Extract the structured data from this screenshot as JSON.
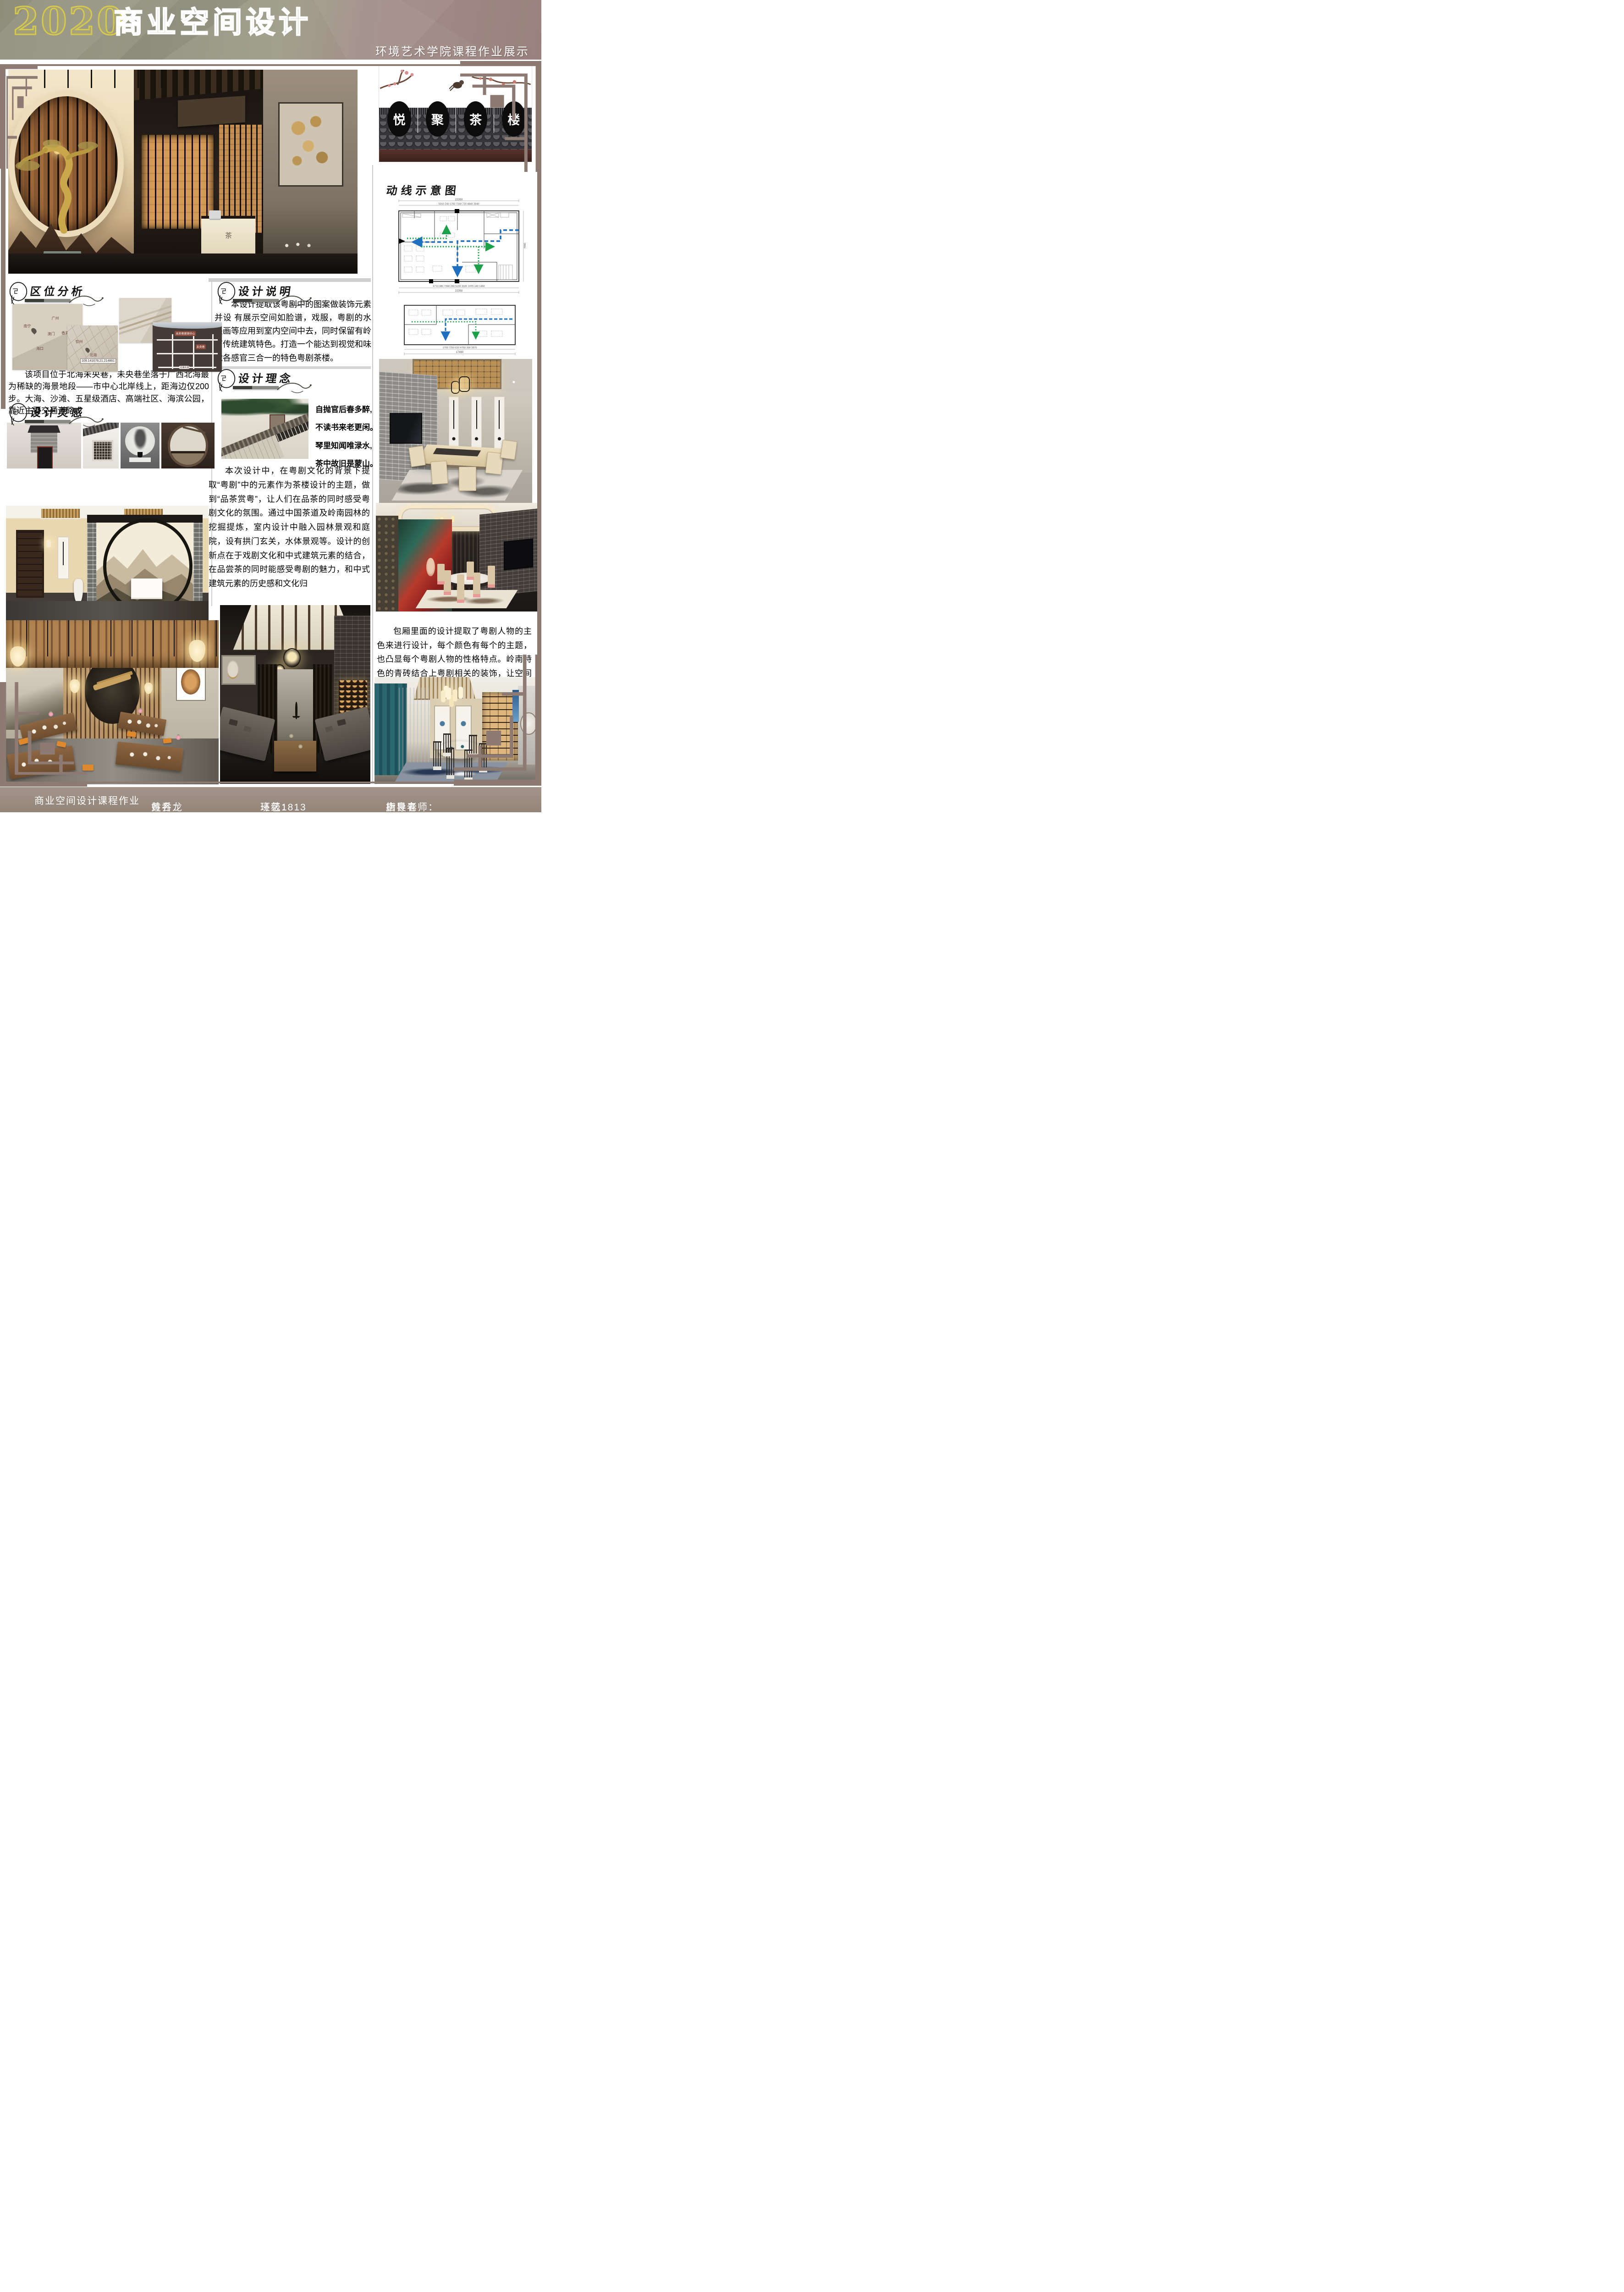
{
  "header": {
    "year": "2020",
    "title": "商业空间设计",
    "subtitle": "环境艺术学院课程作业展示"
  },
  "logo": {
    "chars": [
      "悦",
      "聚",
      "茶",
      "楼"
    ]
  },
  "sections": {
    "circulation_title": "动线示意图",
    "location_title": "区位分析",
    "inspiration_title": "设计灵感",
    "description_title": "设计说明",
    "concept_title": "设计理念"
  },
  "texts": {
    "location": "该项目位于北海未央巷，未央巷坐落于广西北海最为稀缺的海景地段——市中心北岸线上，距海边仅200步。大海、沙滩、五星级酒店、高端社区、海滨公园，靠近主要交通道路。",
    "description": "本设计提取该粤剧中的图案做装饰元素并设 有展示空间如脸谱，戏服，粤剧的水墨画等应用到室内空间中去，同时保留有岭南传统建筑特色。打造一个能达到视觉和味觉各感官三合一的特色粤剧茶楼。",
    "poem": [
      "自抛官后春多醉,",
      "不读书来老更闲。",
      "琴里知闻唯渌水,",
      "茶中故旧是蒙山。"
    ],
    "theme": "本次设计中，在粤剧文化的背景下提取“粤剧”中的元素作为茶楼设计的主题，做到“品茶赏粤”，让人们在品茶的同时感受粤剧文化的氛围。通过中国茶道及岭南园林的挖掘提炼，室内设计中融入园林景观和庭院，设有拱门玄关，水体景观等。设计的创新点在于戏剧文化和中式建筑元素的结合，在品尝茶的同时能感受粤剧的魅力，和中式建筑元素的历史感和文化归",
    "box": "包厢里面的设计提取了粤剧人物的主色来进行设计，每个颜色有每个的主题，也凸显每个粤剧人物的性格特点。岭南特色的青砖结合上粤剧相关的装饰，让空间更具地域性。"
  },
  "maps": {
    "map1": {
      "labels": [
        "南宁",
        "广州",
        "澳门",
        "香港",
        "海口"
      ]
    },
    "map2": {
      "labels": [
        "钦州",
        "北海"
      ],
      "coords": "109.141678,21.214861"
    },
    "map4": {
      "labels": [
        "未央巷营销中心",
        "未央巷",
        "北海大道"
      ]
    }
  },
  "plans": {
    "plan1": {
      "total_top": "22350",
      "dims_top": "5010  240  1700  7160  720  4840  2840",
      "dims_bottom": "6710  380  7390  280  5100  1020 1070 140 1460",
      "total_bottom": "22350",
      "side": "7900"
    },
    "plan2": {
      "total": "17490",
      "dims": "1700  7250  610  4760  300  2870"
    }
  },
  "renders": {
    "entry_desk_label": "茶"
  },
  "footer": {
    "course": "商业空间设计课程作业",
    "name_label": "姓名：",
    "name": "黄乔龙",
    "class_label": "班级：",
    "class_value": "环艺1813",
    "teacher_label": "指导老师：",
    "teacher": "唐良春"
  },
  "colors": {
    "frame_accent": "#8d7a72",
    "footer_bg": "#9a8b80",
    "header_olive": "#97957f",
    "header_mauve": "#a18a85",
    "title_yellow": "#d5c84d",
    "route_blue": "#1f6fc0",
    "route_green": "#1da04a"
  }
}
